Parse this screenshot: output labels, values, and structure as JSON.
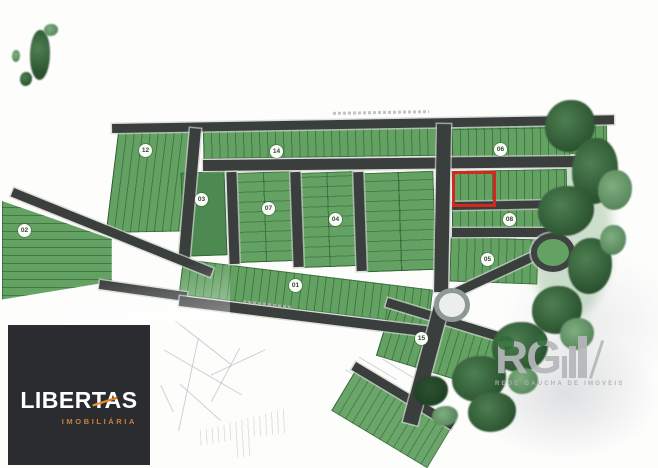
{
  "map": {
    "title": "subdivision-plat-map",
    "block_color": "#63a263",
    "road_color": "#3a3e3c",
    "tree_color": "#2b5330",
    "highlight_color": "#d3281c",
    "blocks": [
      {
        "label": "12"
      },
      {
        "label": "14"
      },
      {
        "label": "02"
      },
      {
        "label": "03"
      },
      {
        "label": "07"
      },
      {
        "label": "04"
      },
      {
        "label": "06"
      },
      {
        "label": "08"
      },
      {
        "label": "05"
      },
      {
        "label": "01"
      },
      {
        "label": "15"
      }
    ]
  },
  "libertas": {
    "brand": "LIBERTAS",
    "tagline": "IMOBILIÁRIA",
    "accent_color": "#ef8f2b",
    "background_color": "#2a2c30"
  },
  "watermark": {
    "brand": "RG",
    "tagline": "REDE GAUCHA DE IMOVEIS",
    "color": "#b5b7ba"
  }
}
